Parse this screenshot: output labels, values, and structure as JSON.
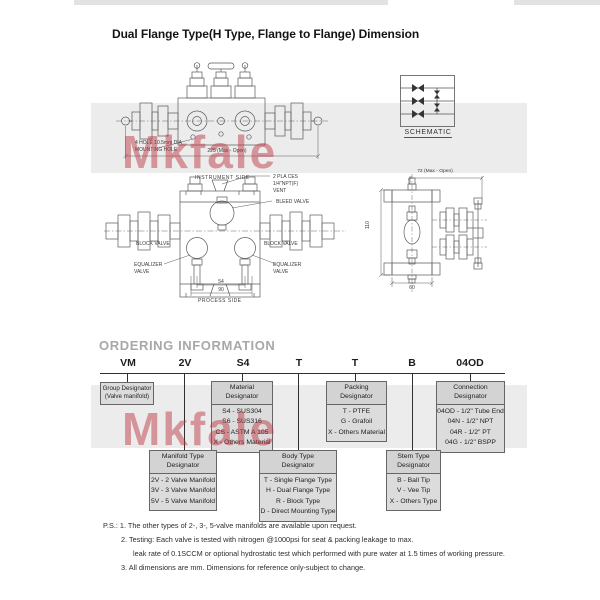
{
  "title": "Dual Flange Type(H Type, Flange to Flange) Dimension",
  "watermark_text": "Mkfale",
  "front_view": {
    "mounting_label_line1": "4 HOLE 10.5mm DIA",
    "mounting_label_line2": "MOUNTING HOLE",
    "width_dim": "225 (Max - Open)"
  },
  "schematic": {
    "caption": "SCHEMATIC"
  },
  "plan_view": {
    "instrument_side": "INSTRUMENT SIDE",
    "process_side": "PROCESS SIDE",
    "vent_line1": "2 PLA CES",
    "vent_line2": "1/4\"NPT(F)",
    "vent_line3": "VENT",
    "bleed_valve": "BLEED VALVE",
    "block_valve_left": "BLOCK VALVE",
    "block_valve_right": "BLOCK VALVE",
    "equalizer_left_l1": "EQUALIZER",
    "equalizer_left_l2": "VALVE",
    "equalizer_right_l1": "EQUALIZER",
    "equalizer_right_l2": "VALVE",
    "dim_54": "54",
    "dim_90": "90"
  },
  "side_view": {
    "width_dim": "72 (Max - Open)",
    "height_dim": "110",
    "depth_dim": "60"
  },
  "ordering": {
    "heading": "ORDERING INFORMATION",
    "code": [
      "VM",
      "2V",
      "S4",
      "T",
      "T",
      "B",
      "04OD"
    ],
    "group_box": {
      "l1": "Group Designator",
      "l2": "(Valve manifold)"
    },
    "material_box": {
      "l1": "Material",
      "l2": "Designator",
      "items": [
        "S4 - SUS304",
        "S6 - SUS316",
        "CS - ASTM A 105",
        "X - Others Material"
      ]
    },
    "packing_box": {
      "l1": "Packing",
      "l2": "Designator",
      "items": [
        "T - PTFE",
        "G - Grafoil",
        "X - Others Material"
      ]
    },
    "connection_box": {
      "l1": "Connection",
      "l2": "Designator",
      "items": [
        "04OD - 1/2\" Tube End",
        "04N - 1/2\" NPT",
        "04R - 1/2\" PT",
        "04G - 1/2\" BSPP"
      ]
    },
    "manifold_box": {
      "l1": "Manifold Type",
      "l2": "Designator",
      "items": [
        "2V - 2 Valve Manifold",
        "3V - 3 Valve Manifold",
        "5V - 5 Valve Manifold"
      ]
    },
    "body_box": {
      "l1": "Body Type",
      "l2": "Designator",
      "items": [
        "T - Single Flange Type",
        "H - Dual Flange Type",
        "R - Block Type",
        "D - Direct Mounting Type"
      ]
    },
    "stem_box": {
      "l1": "Stem Type",
      "l2": "Designator",
      "items": [
        "B - Ball Tip",
        "V - Vee Tip",
        "X - Others Type"
      ]
    }
  },
  "notes": {
    "line1": "P.S.: 1.  The other types of 2-, 3-, 5-valve manifolds are available upon request.",
    "line2": "2.  Testing: Each valve is tested with nitrogen @1000psi for seat & packing leakage to max.",
    "line3": "leak rate of 0.1SCCM or optional hydrostatic test which performed with pure water at 1.5 times of working pressure.",
    "line4": "3.  All dimensions are mm. Dimensions for reference only-subject to change."
  }
}
